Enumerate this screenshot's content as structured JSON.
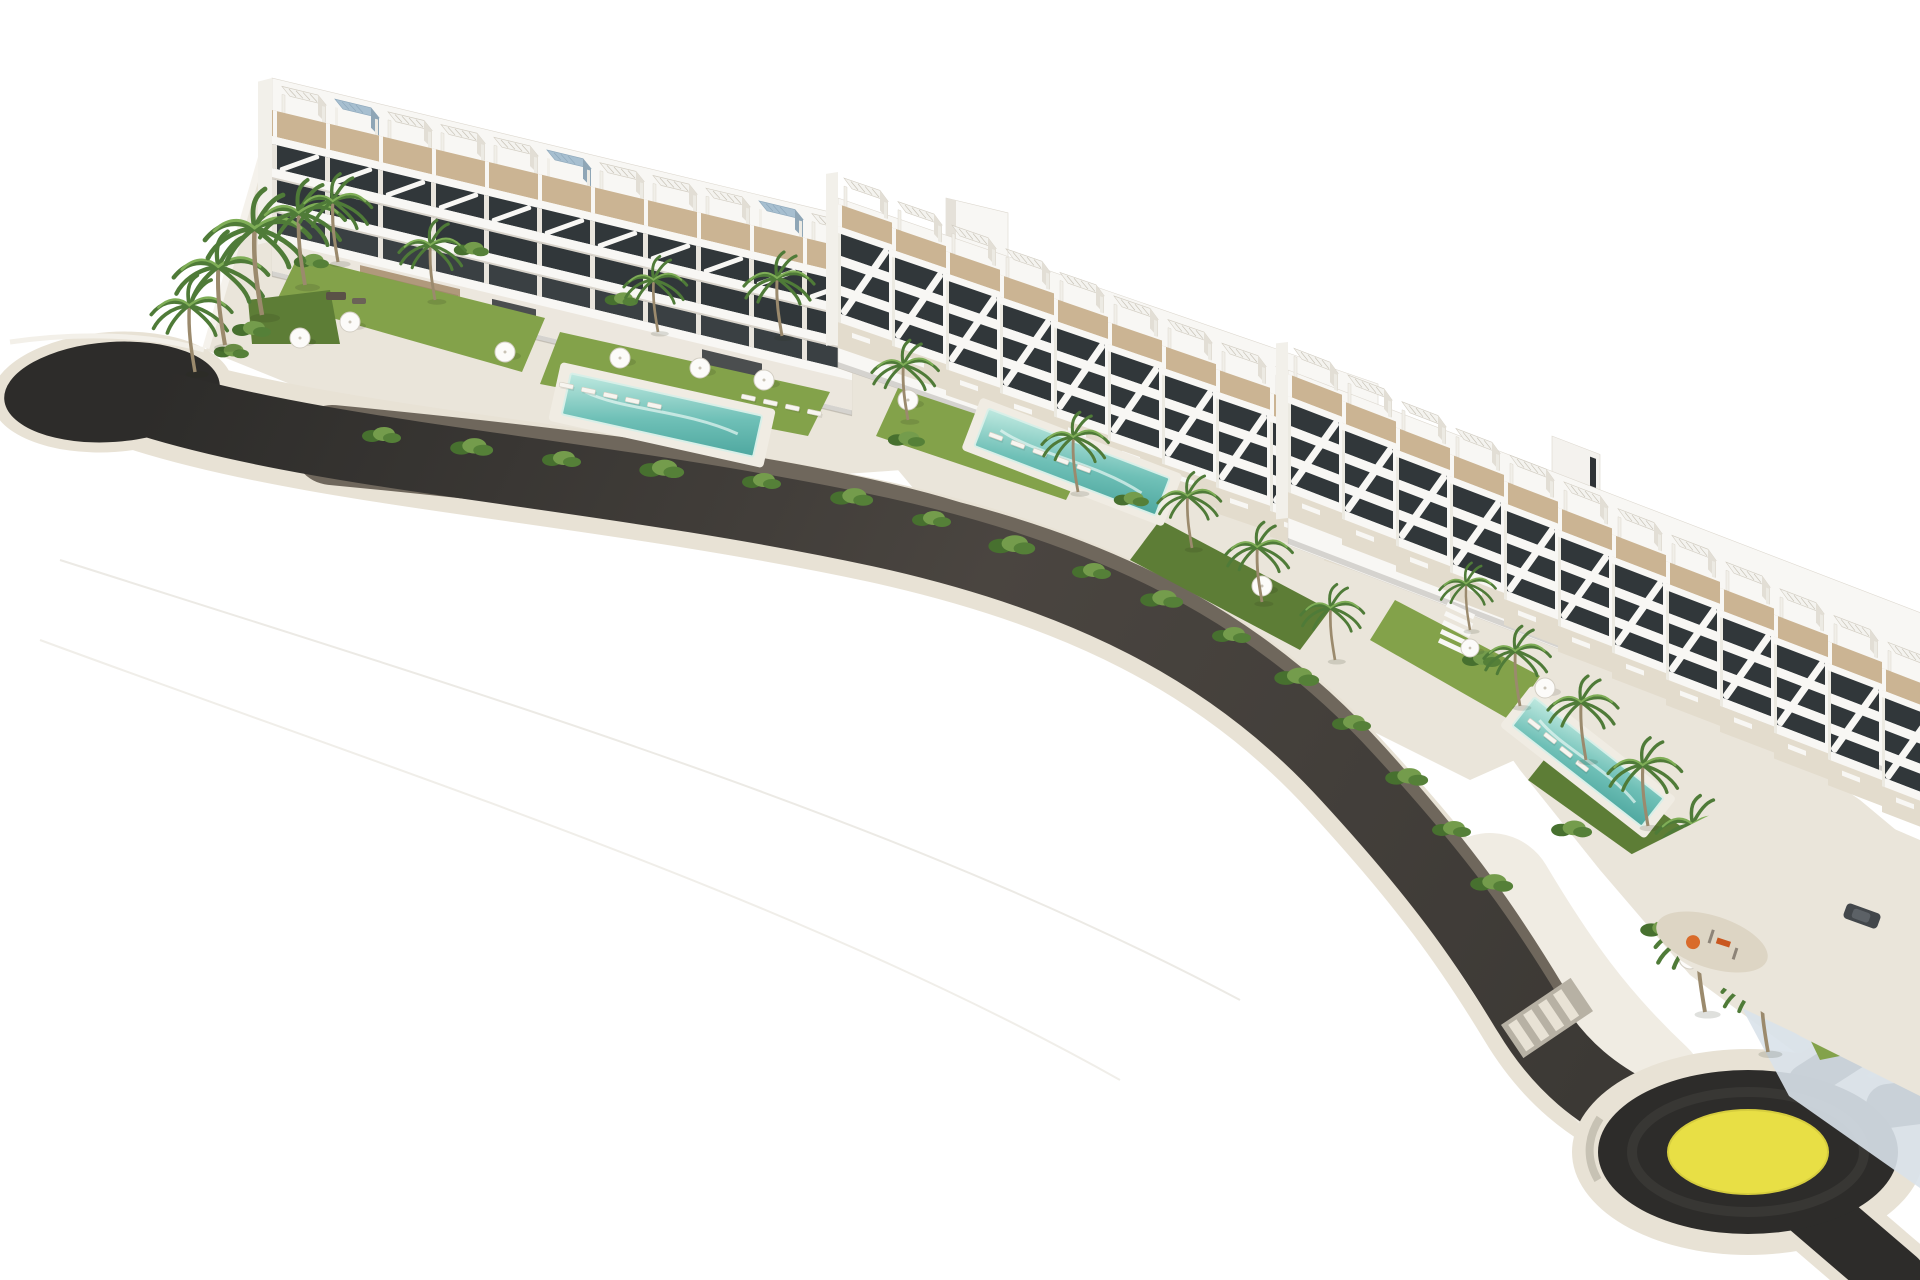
{
  "scene": {
    "scene_type": "aerial-architectural-render",
    "background": "plain white",
    "road": {
      "surface": "dark asphalt with light stone curbs",
      "west_end": "rounded cul-de-sac bulb",
      "crosswalk_present": true,
      "roundabout": {
        "center_island": "yellow disc",
        "position": "bottom-right"
      },
      "exits": [
        "east edge",
        "bottom-right corner",
        "upper parking drive"
      ]
    },
    "buildings": [
      {
        "id": "block-a",
        "position": "upper-left",
        "floors_visible": 4,
        "units_visible": 11,
        "rooftop": "white pergola terraces, tan decks, some glazed tops"
      },
      {
        "id": "block-b",
        "position": "center",
        "floors_visible": 4,
        "units_visible": 10,
        "rooftop": "stepped terraces with diagonal stair parapets"
      },
      {
        "id": "block-c",
        "position": "lower-right",
        "floors_visible": 4,
        "units_visible": 12,
        "rooftop": "stepped terraces descending toward roundabout"
      }
    ],
    "pools": [
      {
        "id": "pool-a",
        "garden": "west garden"
      },
      {
        "id": "pool-b",
        "garden": "center garden"
      },
      {
        "id": "pool-c",
        "garden": "east garden"
      }
    ],
    "landscaping": {
      "palm_trees_visible": 23,
      "parasols_visible": 11,
      "sun_loungers_present": true,
      "lawns_present": true,
      "shrub_borders_present": true,
      "white_boundary_walls": true
    },
    "amenities": {
      "playground_with_orange_equipment": true,
      "parked_car_dark": true,
      "stone_clad_clubhouse_wall": true
    }
  },
  "palette": {
    "white": "#f8f7f4",
    "whiteShade": "#e5e1d9",
    "ground": "#eae5da",
    "curb": "#e8e2d5",
    "sidewalk": "#f0ece3",
    "asphalt": "#3b3834",
    "asphalt_mid": "#4a4540",
    "asphalt_dark": "#2d2c2a",
    "wall": "#6f675c",
    "terrace": "#cbb493",
    "window": "#31373a",
    "grass": "#83a24a",
    "grass_shadow": "#5d7d36",
    "shrub_dark": "#47702f",
    "shrub_light": "#749c4c",
    "pool_light": "#bfe9e0",
    "pool": "#6fc0b7",
    "pool_deep": "#4ea79f",
    "trunk": "#9b8a6d",
    "palm": "#4f7b38",
    "palm_light": "#7fae57",
    "stone": "#b0997c",
    "yellow": "#e8df45",
    "blue_wall": "#d9e2ea",
    "orange": "#d96b2b",
    "crosswalk_base": "#b7b1a4"
  }
}
